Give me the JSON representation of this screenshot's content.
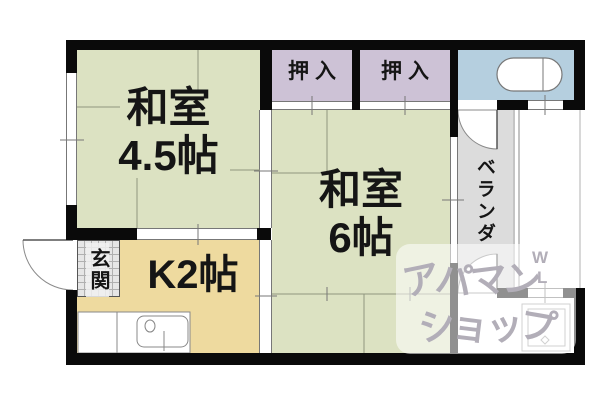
{
  "floorplan": {
    "rooms": {
      "washitsu45": {
        "line1": "和室",
        "line2": "4.5帖"
      },
      "washitsu6": {
        "line1": "和室",
        "line2": "6帖"
      },
      "kitchen": {
        "label": "K2帖"
      },
      "closet1": {
        "label": "押入"
      },
      "closet2": {
        "label": "押入"
      },
      "veranda": {
        "label": "ベランダ"
      },
      "entrance": {
        "label": "玄関"
      }
    },
    "colors": {
      "tatami_room": "#dce2c2",
      "closet": "#cdc2d6",
      "bath": "#b5cfdf",
      "kitchen": "#eeda9f",
      "veranda": "#dcdcdc",
      "entrance_tile": "#e6e6e6",
      "wall": "#0a0a0a",
      "watermark": "#b2aeb8"
    },
    "watermark": {
      "line1": "アパマン",
      "line2": "ショップ",
      "mark_top": "W",
      "mark_bottom": "L"
    }
  }
}
